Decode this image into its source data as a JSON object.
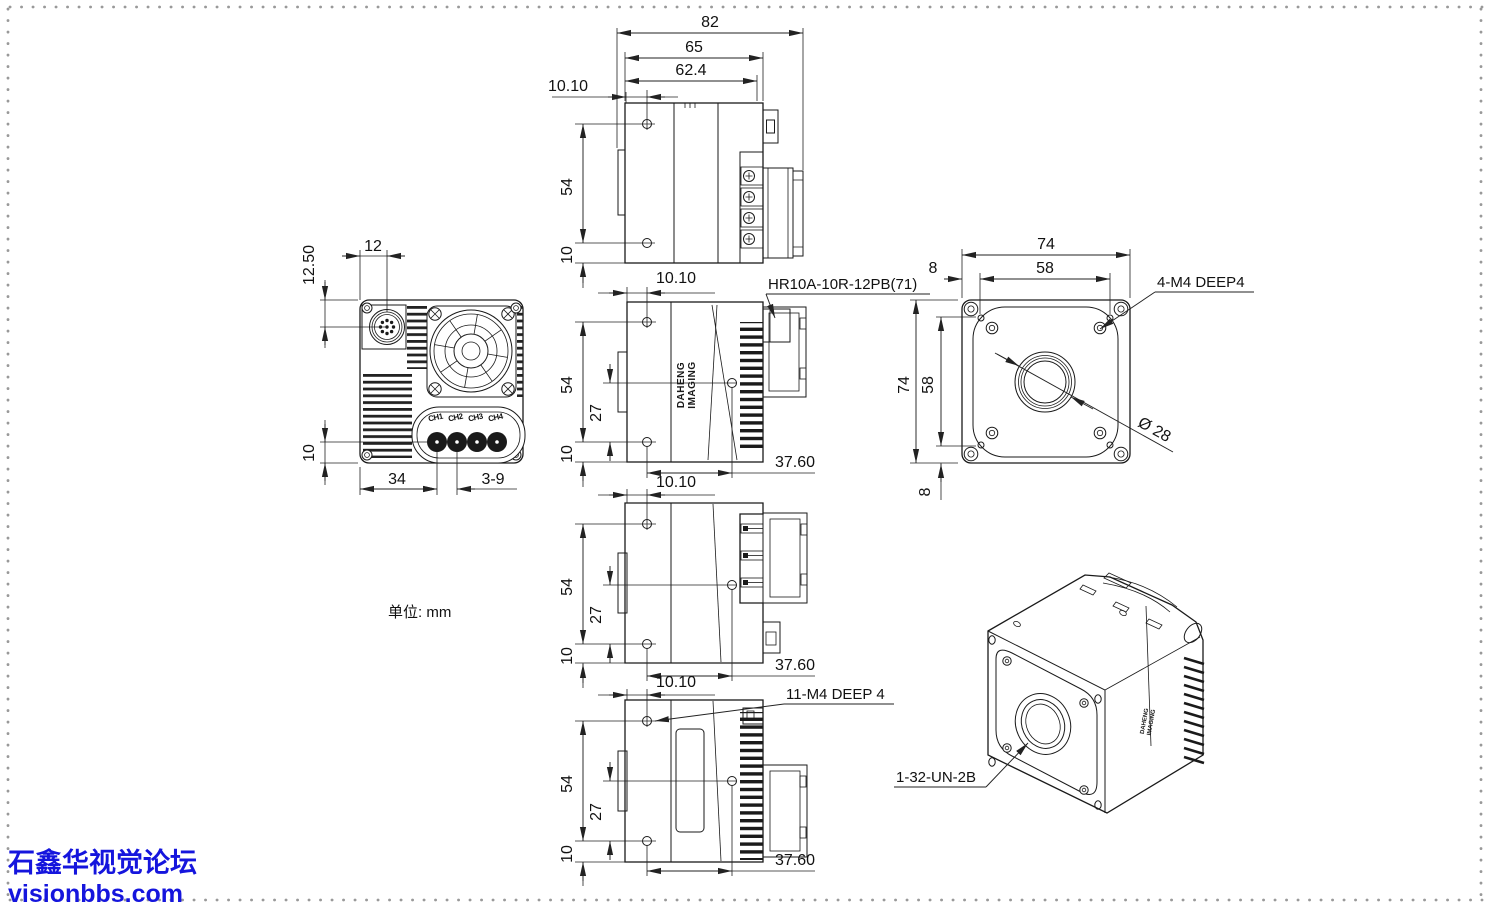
{
  "meta": {
    "unit_note": "单位: mm"
  },
  "watermark": {
    "line1": "石鑫华视觉论坛",
    "line2": "visionbbs.com",
    "color": "#1515dd"
  },
  "logo": {
    "line1": "DAHENG",
    "line2": "IMAGING"
  },
  "labels": {
    "connector": "HR10A-10R-12PB(71)",
    "front_screws": "4-M4 DEEP4",
    "side_screws": "11-M4 DEEP 4",
    "lens_thread": "1-32-UN-2B",
    "lens_diameter": "Ø 28"
  },
  "views": {
    "side_top": {
      "d82": "82",
      "d65": "65",
      "d62_4": "62.4",
      "d10_10": "10.10",
      "d54": "54",
      "d10": "10"
    },
    "rear": {
      "d12_50": "12.50",
      "d12": "12",
      "d10": "10",
      "d34": "34",
      "d3_9": "3-9",
      "channels": [
        "CH1",
        "CH2",
        "CH3",
        "CH4"
      ]
    },
    "side_b": {
      "d10_10": "10.10",
      "d54": "54",
      "d27": "27",
      "d10": "10",
      "d37_60": "37.60"
    },
    "front": {
      "d74_top": "74",
      "d58_top": "58",
      "d8_top": "8",
      "d74_left": "74",
      "d58_left": "58",
      "d8_bottom": "8"
    },
    "side_c": {
      "d10_10": "10.10",
      "d54": "54",
      "d27": "27",
      "d10": "10",
      "d37_60": "37.60"
    },
    "side_d": {
      "d10_10": "10.10",
      "d54": "54",
      "d27": "27",
      "d10": "10",
      "d37_60": "37.60"
    }
  }
}
